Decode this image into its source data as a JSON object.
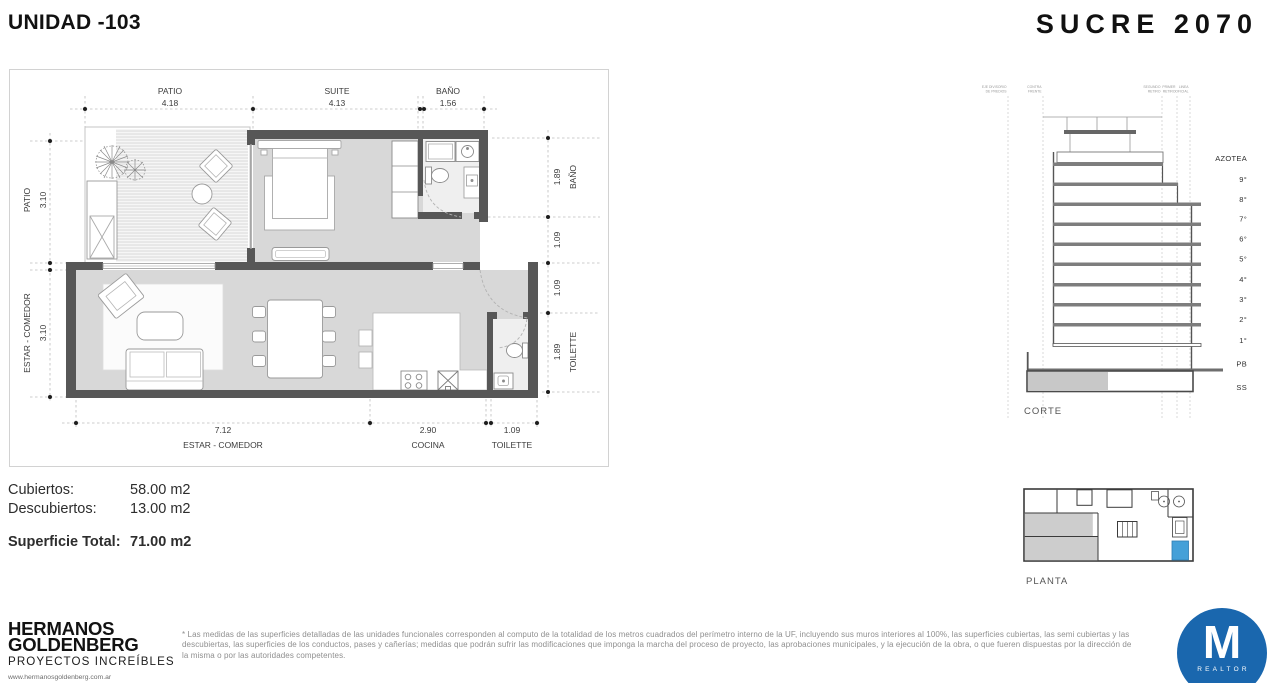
{
  "header": {
    "unit_title": "UNIDAD -103",
    "project_title": "SUCRE 2070"
  },
  "floor_plan": {
    "dims_top": [
      {
        "room": "PATIO",
        "value": "4.18"
      },
      {
        "room": "SUITE",
        "value": "4.13"
      },
      {
        "room": "BAÑO",
        "value": "1.56"
      }
    ],
    "dims_left": [
      {
        "room": "PATIO",
        "value": "3.10"
      },
      {
        "room": "ESTAR - COMEDOR",
        "value": "3.10"
      }
    ],
    "dims_right": [
      {
        "room": "BAÑO",
        "value": "1.89"
      },
      {
        "room": "",
        "value": "1.09"
      },
      {
        "room": "",
        "value": "1.09"
      },
      {
        "room": "TOILETTE",
        "value": "1.89"
      }
    ],
    "dims_bottom": [
      {
        "room": "ESTAR - COMEDOR",
        "value": "7.12"
      },
      {
        "room": "COCINA",
        "value": "2.90"
      },
      {
        "room": "TOILETTE",
        "value": "1.09"
      }
    ]
  },
  "section": {
    "label": "CORTE",
    "floors": [
      "AZOTEA",
      "9°",
      "8°",
      "7°",
      "6°",
      "5°",
      "4°",
      "3°",
      "2°",
      "1°",
      "PB",
      "SS"
    ],
    "axis_labels": [
      [
        "EJE DIVISORIO",
        "DE PREDIOS"
      ],
      [
        "CONTRA",
        "FRENTE"
      ],
      [
        "SEGUNDO",
        "RETIRO"
      ],
      [
        "PRIMER",
        "RETIRO"
      ],
      [
        "LINEA",
        "OFICIAL"
      ]
    ]
  },
  "key_plan": {
    "label": "PLANTA"
  },
  "areas": {
    "rows": [
      {
        "label": "Cubiertos:",
        "value": "58.00 m2"
      },
      {
        "label": "Descubiertos:",
        "value": "13.00 m2"
      }
    ],
    "total_label": "Superficie Total:",
    "total_value": "71.00 m2"
  },
  "footer": {
    "brand_line1": "HERMANOS",
    "brand_line2": "GOLDENBERG",
    "brand_tagline": "PROYECTOS INCREÍBLES",
    "brand_url": "www.hermanosgoldenberg.com.ar",
    "disclaimer": "* Las medidas de las superficies detalladas de las unidades funcionales corresponden al computo de la totalidad de los metros cuadrados del perímetro interno de la UF, incluyendo sus muros interiores al 100%, las superficies cubiertas, las semi cubiertas y las descubiertas, las superficies de los conductos, pases y cañerías; medidas que podrán sufrir las modificaciones que imponga la marcha del proceso de proyecto, las aprobaciones municipales, y la ejecución de la obra, o que fueren dispuestas por la dirección de la misma o por las autoridades competentes.",
    "realtor_initial": "M",
    "realtor_label": "REALTOR"
  },
  "colors": {
    "wall_gray": "#575757",
    "floor_gray": "#d8d8d8",
    "pool_blue": "#45a0d8",
    "logo_blue": "#1a67ae"
  }
}
